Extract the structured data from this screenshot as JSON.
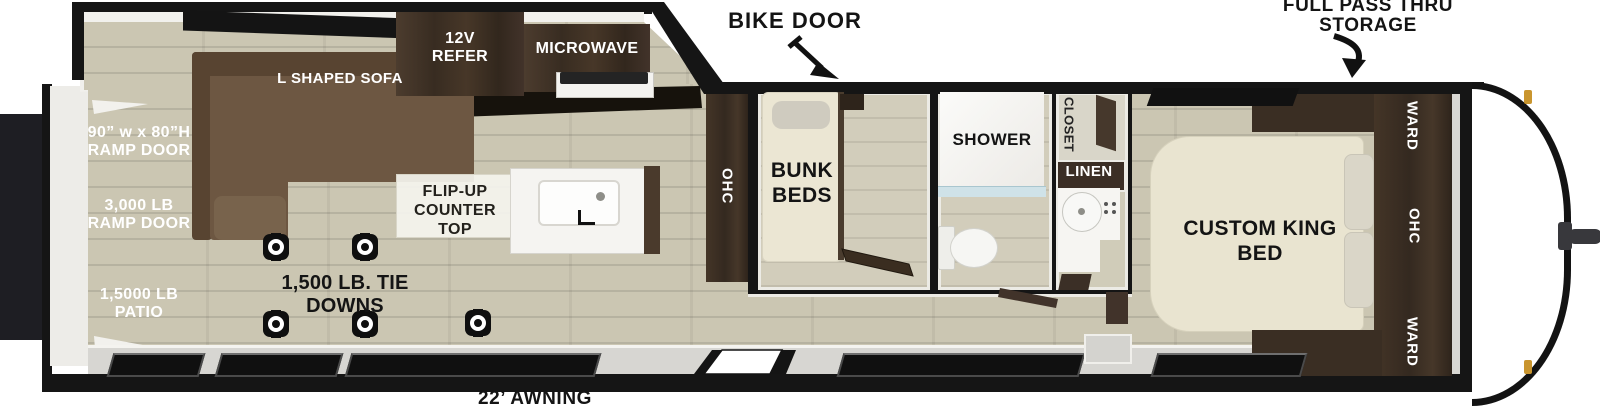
{
  "annotations": {
    "bike_door": "BIKE DOOR",
    "full_pass_thru": "FULL PASS THRU\nSTORAGE",
    "awning": "22’ AWNING"
  },
  "patio": {
    "ramp_size": "90” w x 80”H\nRAMP DOOR",
    "ramp_capacity": "3,000 LB\nRAMP DOOR",
    "patio_capacity": "1,5000 LB\nPATIO"
  },
  "garage": {
    "sofa": "L SHAPED SOFA",
    "refer": "12V\nREFER",
    "microwave": "MICROWAVE",
    "counter": "FLIP-UP\nCOUNTER TOP",
    "tie_downs": "1,500 LB. TIE DOWNS",
    "ohc": "OHC"
  },
  "bunk_room": {
    "label": "BUNK\nBEDS"
  },
  "bath": {
    "shower": "SHOWER",
    "closet": "CLOSET",
    "linen": "LINEN"
  },
  "bedroom": {
    "bed": "CUSTOM KING\nBED",
    "ward_top": "WARD",
    "ohc": "OHC",
    "ward_bottom": "WARD"
  }
}
